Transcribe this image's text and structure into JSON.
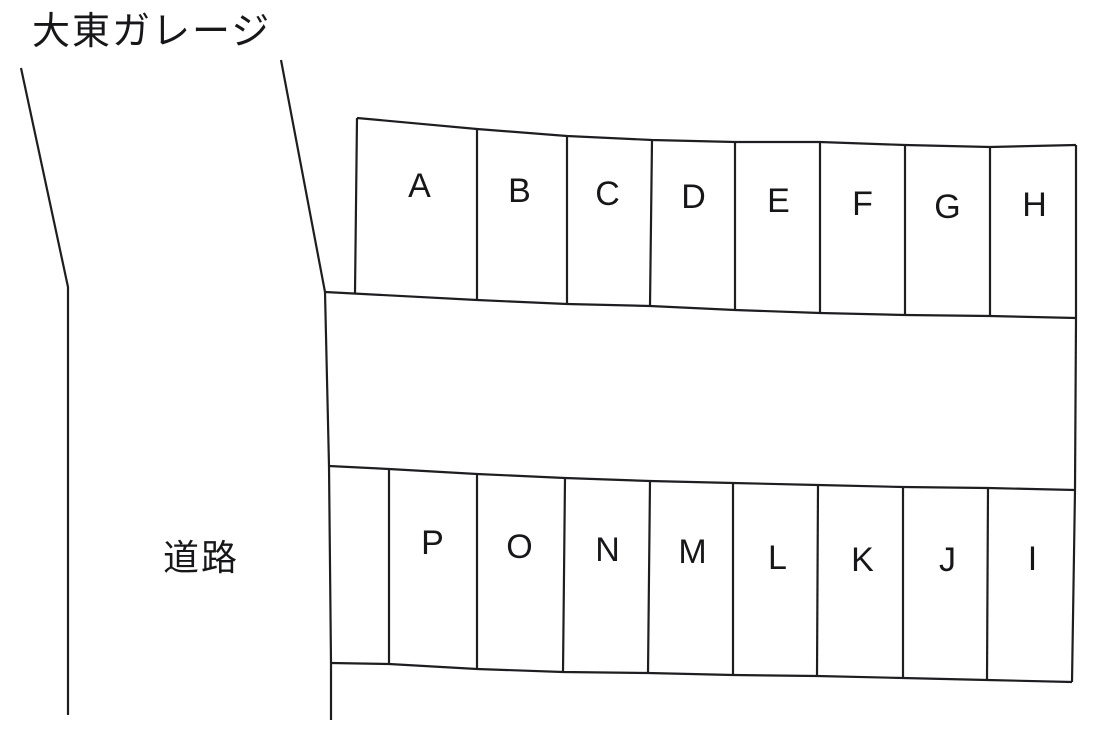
{
  "title": "大東ガレージ",
  "road_label": "道路",
  "diagram_type": "parking-lot-layout",
  "rows": [
    {
      "id": "upper",
      "spaces": [
        "A",
        "B",
        "C",
        "D",
        "E",
        "F",
        "G",
        "H"
      ]
    },
    {
      "id": "lower",
      "spaces": [
        "P",
        "O",
        "N",
        "M",
        "L",
        "K",
        "J",
        "I"
      ]
    }
  ],
  "colors": {
    "line": "#1e1e20",
    "text": "#17171a",
    "background": "#ffffff"
  }
}
